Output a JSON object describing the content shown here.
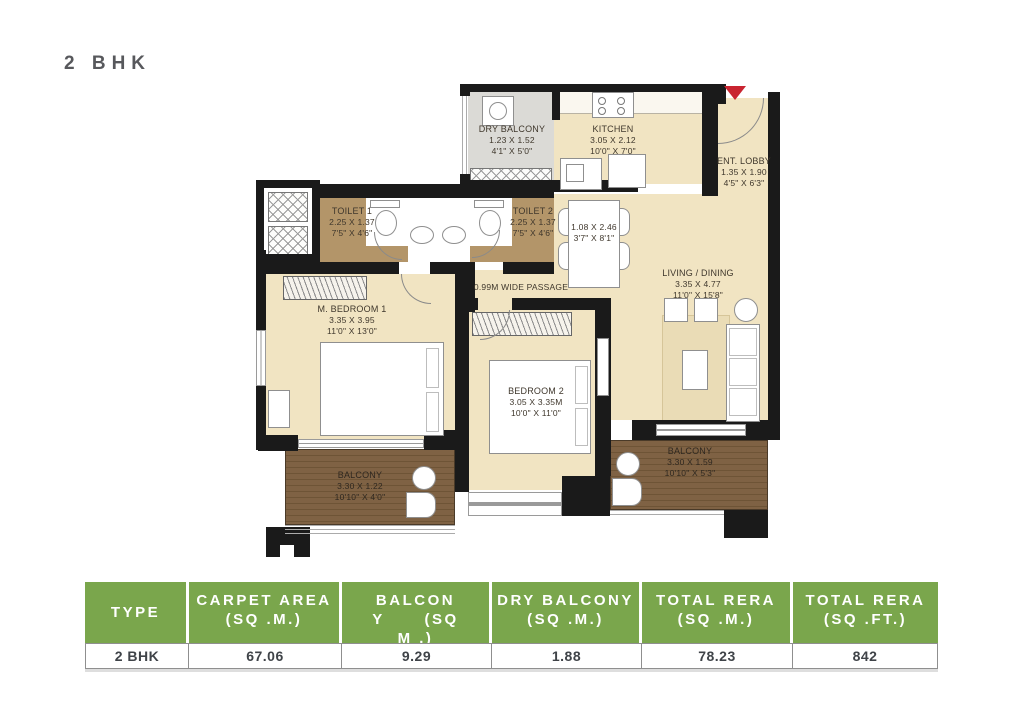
{
  "title": "2 BHK",
  "colors": {
    "table_header_green": "#7aa64c",
    "entrance_arrow_red": "#c92430",
    "wall_black": "#1a1a1a",
    "floor_beige": "#f1e4c2",
    "toilet_floor_tan": "#b39569",
    "balcony_wood_brown": "#7f6244",
    "dry_balcony_gray": "#dbdad6"
  },
  "plan": {
    "passage_label": "0.99M WIDE PASSAGE",
    "rooms": {
      "dry_balcony": {
        "name": "DRY BALCONY",
        "dim_m": "1.23 X 1.52",
        "dim_ft": "4'1\" X 5'0\""
      },
      "kitchen": {
        "name": "KITCHEN",
        "dim_m": "3.05 X 2.12",
        "dim_ft": "10'0\" X 7'0\""
      },
      "ent_lobby": {
        "name": "ENT. LOBBY",
        "dim_m": "1.35 X 1.90",
        "dim_ft": "4'5\" X 6'3\""
      },
      "toilet1": {
        "name": "TOILET 1",
        "dim_m": "2.25 X 1.37",
        "dim_ft": "7'5\" X 4'6\""
      },
      "toilet2": {
        "name": "TOILET 2",
        "dim_m": "2.25 X 1.37",
        "dim_ft": "7'5\" X 4'6\""
      },
      "dining": {
        "dim_m": "1.08 X 2.46",
        "dim_ft": "3'7\" X 8'1\""
      },
      "living_dining": {
        "name": "LIVING / DINING",
        "dim_m": "3.35 X 4.77",
        "dim_ft": "11'0\" X 15'8\""
      },
      "m_bedroom1": {
        "name": "M. BEDROOM 1",
        "dim_m": "3.35 X 3.95",
        "dim_ft": "11'0\" X 13'0\""
      },
      "bedroom2": {
        "name": "BEDROOM 2",
        "dim_m": "3.05 X 3.35M",
        "dim_ft": "10'0\" X 11'0\""
      },
      "balcony_left": {
        "name": "BALCONY",
        "dim_m": "3.30 X 1.22",
        "dim_ft": "10'10\" X 4'0\""
      },
      "balcony_right": {
        "name": "BALCONY",
        "dim_m": "3.30 X 1.59",
        "dim_ft": "10'10\" X 5'3\""
      }
    }
  },
  "table": {
    "headers": {
      "type": {
        "l1": "TYPE"
      },
      "carpet": {
        "l1": "CARPET AREA",
        "l2": "(SQ .M.)"
      },
      "balcony": {
        "l1": "BALCON",
        "l2": "Y      (SQ",
        "l3": "M .)"
      },
      "dry_balcony": {
        "l1": "DRY BALCONY",
        "l2": "(SQ .M.)"
      },
      "total_sqm": {
        "l1": "TOTAL RERA",
        "l2": "(SQ .M.)"
      },
      "total_sqft": {
        "l1": "TOTAL RERA",
        "l2": "(SQ .FT.)"
      }
    },
    "row": {
      "type": "2 BHK",
      "carpet": "67.06",
      "balcony": "9.29",
      "dry_balcony": "1.88",
      "total_sqm": "78.23",
      "total_sqft": "842"
    }
  }
}
